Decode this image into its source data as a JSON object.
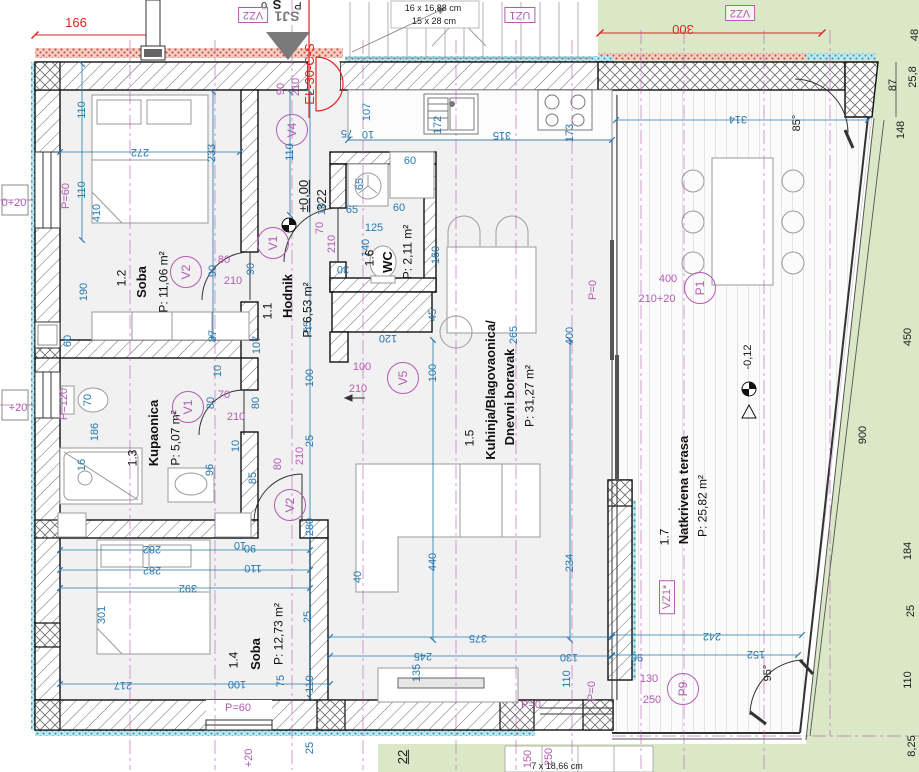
{
  "drawing": {
    "type": "floor-plan",
    "level_main": "±0,00",
    "level_terrace": "-0,12"
  },
  "colors": {
    "dim_blue": "#2878ad",
    "center_purple": "#b35cb3",
    "accent_red": "#e02424",
    "grass": "#dbe8c8",
    "floor": "#f1f1f2",
    "wall_line": "#111111",
    "cyan_insulation": "#2fa3bf"
  },
  "rooms": [
    {
      "number": {
        "t": "1.1",
        "x": 268,
        "y": 311
      },
      "name": {
        "t": "Hodnik",
        "x": 288,
        "y": 296
      },
      "area": {
        "t": "P: 6,53 m²",
        "x": 308,
        "y": 310
      }
    },
    {
      "number": {
        "t": "1.2",
        "x": 122,
        "y": 278
      },
      "name": {
        "t": "Soba",
        "x": 142,
        "y": 282
      },
      "area": {
        "t": "P: 11,06 m²",
        "x": 164,
        "y": 282
      }
    },
    {
      "number": {
        "t": "1.3",
        "x": 133,
        "y": 458
      },
      "name": {
        "t": "Kupaonica",
        "x": 154,
        "y": 433
      },
      "area": {
        "t": "P: 5,07 m²",
        "x": 176,
        "y": 438
      }
    },
    {
      "number": {
        "t": "1.4",
        "x": 234,
        "y": 660
      },
      "name": {
        "t": "Soba",
        "x": 256,
        "y": 654
      },
      "area": {
        "t": "P: 12,73 m²",
        "x": 279,
        "y": 634
      }
    },
    {
      "number": {
        "t": "1.5",
        "x": 470,
        "y": 438
      },
      "name": {
        "t": "Kuhinja/Blagovaonica/",
        "x": 491,
        "y": 390
      },
      "name2": {
        "t": "Dnevni boravak",
        "x": 510,
        "y": 397
      },
      "area": {
        "t": "P: 31,27 m²",
        "x": 530,
        "y": 396
      }
    },
    {
      "number": {
        "t": "1.6",
        "x": 370,
        "y": 258
      },
      "name": {
        "t": "WC",
        "x": 388,
        "y": 262
      },
      "area": {
        "t": "P: 2,11 m²",
        "x": 408,
        "y": 252
      }
    },
    {
      "number": {
        "t": "1.7",
        "x": 665,
        "y": 537
      },
      "name": {
        "t": "Natkrivena terasa",
        "x": 684,
        "y": 490
      },
      "area": {
        "t": "P: 25,82 m²",
        "x": 703,
        "y": 506
      }
    }
  ],
  "door_tags": [
    {
      "t": "V4",
      "x": 292,
      "y": 130
    },
    {
      "t": "V1",
      "x": 273,
      "y": 243
    },
    {
      "t": "V2",
      "x": 186,
      "y": 272
    },
    {
      "t": "V1",
      "x": 188,
      "y": 407
    },
    {
      "t": "V2",
      "x": 290,
      "y": 505
    },
    {
      "t": "V5",
      "x": 403,
      "y": 378
    },
    {
      "t": "P1",
      "x": 700,
      "y": 288
    },
    {
      "t": "P9",
      "x": 683,
      "y": 689
    }
  ],
  "boxed_tags": [
    {
      "t": "VZ2",
      "x": 253,
      "y": 15,
      "r": 180
    },
    {
      "t": "UZ1",
      "x": 520,
      "y": 15,
      "r": 180
    },
    {
      "t": "VZ2",
      "x": 740,
      "y": 13,
      "r": 180
    },
    {
      "t": "VZ1*",
      "x": 667,
      "y": 597,
      "r": -90
    }
  ],
  "labels": [
    {
      "t": "166",
      "x": 76,
      "y": 23,
      "c": "r",
      "n": "red-dim"
    },
    {
      "t": "300",
      "x": 683,
      "y": 29,
      "r": 180,
      "c": "r",
      "n": "red-dim"
    },
    {
      "t": "EL-30-C-S",
      "x": 310,
      "y": 74,
      "r": -90,
      "c": "r",
      "n": "electrical-tag"
    },
    {
      "t": "SJ1",
      "x": 287,
      "y": 16,
      "r": 180,
      "c": "g",
      "n": "section-marker-label"
    },
    {
      "t": "0",
      "x": 264,
      "y": 5,
      "r": 180,
      "c": "k",
      "n": "cutoff-text"
    },
    {
      "t": "S",
      "x": 277,
      "y": 4,
      "r": 180,
      "c": "k bold lg",
      "n": "cutoff-text"
    },
    {
      "t": "P",
      "x": 298,
      "y": 5,
      "r": 180,
      "c": "k",
      "n": "cutoff-text"
    },
    {
      "t": "16 x 16,88 cm",
      "x": 433,
      "y": 9,
      "c": "k sm",
      "n": "stair-spec"
    },
    {
      "t": "15 x 28 cm",
      "x": 434,
      "y": 22,
      "c": "k sm",
      "n": "stair-spec"
    },
    {
      "t": "7 x 18,66 cm",
      "x": 557,
      "y": 767,
      "c": "k sm",
      "n": "stair-spec"
    },
    {
      "t": "±0,00",
      "x": 304,
      "y": 196,
      "r": -90,
      "c": "k u lg",
      "n": "level-marker"
    },
    {
      "t": "322",
      "x": 322,
      "y": 200,
      "r": -90,
      "c": "k lg",
      "n": "dim"
    },
    {
      "t": "-0,12",
      "x": 748,
      "y": 357,
      "r": -90,
      "c": "k",
      "n": "level-marker"
    },
    {
      "t": "85°",
      "x": 797,
      "y": 123,
      "r": -90,
      "c": "k",
      "n": "angle"
    },
    {
      "t": "95°",
      "x": 768,
      "y": 673,
      "r": -90,
      "c": "k",
      "n": "angle"
    },
    {
      "t": "22",
      "x": 403,
      "y": 757,
      "r": -90,
      "c": "k u lg",
      "n": "dim"
    },
    {
      "t": "110",
      "x": 82,
      "y": 110,
      "r": -90
    },
    {
      "t": "110",
      "x": 82,
      "y": 190,
      "r": -90
    },
    {
      "t": "410",
      "x": 97,
      "y": 213,
      "r": -90
    },
    {
      "t": "190",
      "x": 84,
      "y": 292,
      "r": -90
    },
    {
      "t": "60",
      "x": 68,
      "y": 341,
      "r": -90
    },
    {
      "t": "272",
      "x": 140,
      "y": 152,
      "r": 180
    },
    {
      "t": "233",
      "x": 212,
      "y": 153,
      "r": -90
    },
    {
      "t": "110",
      "x": 290,
      "y": 152,
      "r": -90
    },
    {
      "t": "90",
      "x": 213,
      "y": 271,
      "r": -90
    },
    {
      "t": "90",
      "x": 251,
      "y": 269,
      "r": -90
    },
    {
      "t": "87",
      "x": 213,
      "y": 336,
      "r": -90
    },
    {
      "t": "10",
      "x": 218,
      "y": 371,
      "r": -90
    },
    {
      "t": "107",
      "x": 257,
      "y": 345,
      "r": -90
    },
    {
      "t": "55",
      "x": 308,
      "y": 327,
      "r": -90
    },
    {
      "t": "100",
      "x": 310,
      "y": 378,
      "r": -90
    },
    {
      "t": "25",
      "x": 310,
      "y": 441,
      "r": -90
    },
    {
      "t": "280",
      "x": 310,
      "y": 527,
      "r": -90
    },
    {
      "t": "25",
      "x": 308,
      "y": 617,
      "r": -90
    },
    {
      "t": "110",
      "x": 310,
      "y": 684,
      "r": -90
    },
    {
      "t": "75",
      "x": 281,
      "y": 681,
      "r": -90
    },
    {
      "t": "25",
      "x": 310,
      "y": 748,
      "r": -90
    },
    {
      "t": "10",
      "x": 322,
      "y": 209,
      "r": -90
    },
    {
      "t": "107",
      "x": 367,
      "y": 112,
      "r": -90
    },
    {
      "t": "75",
      "x": 347,
      "y": 133,
      "r": 180
    },
    {
      "t": "10",
      "x": 368,
      "y": 134,
      "r": 180
    },
    {
      "t": "172",
      "x": 438,
      "y": 125,
      "r": -90
    },
    {
      "t": "315",
      "x": 502,
      "y": 135,
      "r": 180
    },
    {
      "t": "173",
      "x": 570,
      "y": 133,
      "r": -90
    },
    {
      "t": "60",
      "x": 410,
      "y": 161
    },
    {
      "t": "65",
      "x": 360,
      "y": 184,
      "r": -90
    },
    {
      "t": "65",
      "x": 352,
      "y": 210
    },
    {
      "t": "60",
      "x": 399,
      "y": 208
    },
    {
      "t": "125",
      "x": 374,
      "y": 228
    },
    {
      "t": "140",
      "x": 366,
      "y": 248,
      "r": -90
    },
    {
      "t": "160",
      "x": 436,
      "y": 255,
      "r": -90
    },
    {
      "t": "30",
      "x": 343,
      "y": 269,
      "r": 180
    },
    {
      "t": "45",
      "x": 433,
      "y": 315,
      "r": -90
    },
    {
      "t": "70",
      "x": 88,
      "y": 400,
      "r": -90
    },
    {
      "t": "186",
      "x": 95,
      "y": 432,
      "r": -90
    },
    {
      "t": "16",
      "x": 82,
      "y": 465,
      "r": -90
    },
    {
      "t": "96",
      "x": 210,
      "y": 470,
      "r": -90
    },
    {
      "t": "85",
      "x": 253,
      "y": 478,
      "r": -90
    },
    {
      "t": "10",
      "x": 236,
      "y": 446,
      "r": -90
    },
    {
      "t": "80",
      "x": 211,
      "y": 403,
      "r": -90
    },
    {
      "t": "80",
      "x": 256,
      "y": 403,
      "r": -90
    },
    {
      "t": "282",
      "x": 152,
      "y": 549,
      "r": 180
    },
    {
      "t": "282",
      "x": 152,
      "y": 570,
      "r": 180
    },
    {
      "t": "392",
      "x": 188,
      "y": 588,
      "r": 180
    },
    {
      "t": "301",
      "x": 102,
      "y": 615,
      "r": -90
    },
    {
      "t": "217",
      "x": 123,
      "y": 685,
      "r": 180
    },
    {
      "t": "100",
      "x": 237,
      "y": 684,
      "r": 180
    },
    {
      "t": "90",
      "x": 250,
      "y": 548,
      "r": 180
    },
    {
      "t": "10",
      "x": 240,
      "y": 545,
      "r": 180
    },
    {
      "t": "110",
      "x": 253,
      "y": 568,
      "r": 180
    },
    {
      "t": "120",
      "x": 388,
      "y": 338,
      "r": 180
    },
    {
      "t": "100",
      "x": 433,
      "y": 373,
      "r": -90
    },
    {
      "t": "265",
      "x": 514,
      "y": 335,
      "r": -90
    },
    {
      "t": "400",
      "x": 570,
      "y": 336,
      "r": -90
    },
    {
      "t": "440",
      "x": 433,
      "y": 562,
      "r": -90
    },
    {
      "t": "40",
      "x": 358,
      "y": 577,
      "r": -90
    },
    {
      "t": "234",
      "x": 570,
      "y": 563,
      "r": -90
    },
    {
      "t": "375",
      "x": 478,
      "y": 638,
      "r": 180
    },
    {
      "t": "245",
      "x": 423,
      "y": 656,
      "r": 180
    },
    {
      "t": "135",
      "x": 417,
      "y": 673,
      "r": -90
    },
    {
      "t": "130",
      "x": 569,
      "y": 657,
      "r": 180
    },
    {
      "t": "110",
      "x": 567,
      "y": 679,
      "r": -90
    },
    {
      "t": "314",
      "x": 738,
      "y": 119,
      "r": 180
    },
    {
      "t": "242",
      "x": 712,
      "y": 636,
      "r": 180
    },
    {
      "t": "90",
      "x": 637,
      "y": 657,
      "r": 180
    },
    {
      "t": "152",
      "x": 756,
      "y": 654,
      "r": 180
    },
    {
      "t": "48",
      "x": 915,
      "y": 35,
      "r": -90,
      "c": "k",
      "n": "site-dim"
    },
    {
      "t": "25,8",
      "x": 913,
      "y": 77,
      "r": -90,
      "c": "k",
      "n": "site-dim"
    },
    {
      "t": "87",
      "x": 893,
      "y": 85,
      "r": -90,
      "c": "k",
      "n": "site-dim"
    },
    {
      "t": "148",
      "x": 901,
      "y": 130,
      "r": -90,
      "c": "k",
      "n": "site-dim"
    },
    {
      "t": "450",
      "x": 908,
      "y": 337,
      "r": -90,
      "c": "k",
      "n": "site-dim"
    },
    {
      "t": "900",
      "x": 863,
      "y": 435,
      "r": -90,
      "c": "k",
      "n": "site-dim"
    },
    {
      "t": "184",
      "x": 908,
      "y": 551,
      "r": -90,
      "c": "k",
      "n": "site-dim"
    },
    {
      "t": "25",
      "x": 911,
      "y": 611,
      "r": -90,
      "c": "k",
      "n": "site-dim"
    },
    {
      "t": "110",
      "x": 908,
      "y": 680,
      "r": -90,
      "c": "k",
      "n": "site-dim"
    },
    {
      "t": "8,25",
      "x": 912,
      "y": 746,
      "r": -90,
      "c": "k",
      "n": "site-dim"
    },
    {
      "t": "0+20",
      "x": 14,
      "y": 203,
      "c": "p",
      "n": "door-spec"
    },
    {
      "t": "P=60",
      "x": 66,
      "y": 196,
      "r": -90,
      "c": "p",
      "n": "parapet"
    },
    {
      "t": "+20",
      "x": 18,
      "y": 408,
      "c": "p",
      "n": "door-spec"
    },
    {
      "t": "P=120",
      "x": 64,
      "y": 404,
      "r": -90,
      "c": "p",
      "n": "parapet"
    },
    {
      "t": "P=60",
      "x": 238,
      "y": 708,
      "c": "p",
      "n": "parapet"
    },
    {
      "t": "+20",
      "x": 249,
      "y": 758,
      "r": -90,
      "c": "p",
      "n": "door-spec"
    },
    {
      "t": "150",
      "x": 528,
      "y": 759,
      "r": -90,
      "c": "p",
      "n": "door-spec"
    },
    {
      "t": "250",
      "x": 549,
      "y": 757,
      "r": -90,
      "c": "p",
      "n": "door-spec"
    },
    {
      "t": "P=0",
      "x": 531,
      "y": 705,
      "c": "p",
      "n": "parapet"
    },
    {
      "t": "P=0",
      "x": 592,
      "y": 691,
      "r": -90,
      "c": "p",
      "n": "parapet"
    },
    {
      "t": "P=0",
      "x": 593,
      "y": 290,
      "r": -90,
      "c": "p",
      "n": "parapet"
    },
    {
      "t": "400",
      "x": 668,
      "y": 279,
      "c": "p",
      "n": "door-spec"
    },
    {
      "t": "210+20",
      "x": 657,
      "y": 299,
      "c": "p",
      "n": "door-spec"
    },
    {
      "t": "130",
      "x": 649,
      "y": 679,
      "c": "p",
      "n": "door-spec"
    },
    {
      "t": "250",
      "x": 652,
      "y": 700,
      "c": "p",
      "n": "door-spec"
    },
    {
      "t": "90",
      "x": 281,
      "y": 89,
      "r": -90,
      "c": "p",
      "n": "door-spec"
    },
    {
      "t": "210",
      "x": 296,
      "y": 87,
      "r": -90,
      "c": "p",
      "n": "door-spec"
    },
    {
      "t": "80",
      "x": 224,
      "y": 260,
      "c": "p",
      "n": "door-spec"
    },
    {
      "t": "210",
      "x": 233,
      "y": 281,
      "c": "p",
      "n": "door-spec"
    },
    {
      "t": "70",
      "x": 320,
      "y": 228,
      "r": -90,
      "c": "p",
      "n": "door-spec"
    },
    {
      "t": "210",
      "x": 332,
      "y": 244,
      "r": -90,
      "c": "p",
      "n": "door-spec"
    },
    {
      "t": "70",
      "x": 224,
      "y": 395,
      "c": "p",
      "n": "door-spec"
    },
    {
      "t": "210",
      "x": 236,
      "y": 417,
      "c": "p",
      "n": "door-spec"
    },
    {
      "t": "80",
      "x": 278,
      "y": 464,
      "r": -90,
      "c": "p",
      "n": "door-spec"
    },
    {
      "t": "210",
      "x": 300,
      "y": 456,
      "r": -90,
      "c": "p",
      "n": "door-spec"
    },
    {
      "t": "100",
      "x": 362,
      "y": 367,
      "c": "p",
      "n": "door-spec"
    },
    {
      "t": "210",
      "x": 358,
      "y": 389,
      "c": "p",
      "n": "door-spec"
    }
  ]
}
